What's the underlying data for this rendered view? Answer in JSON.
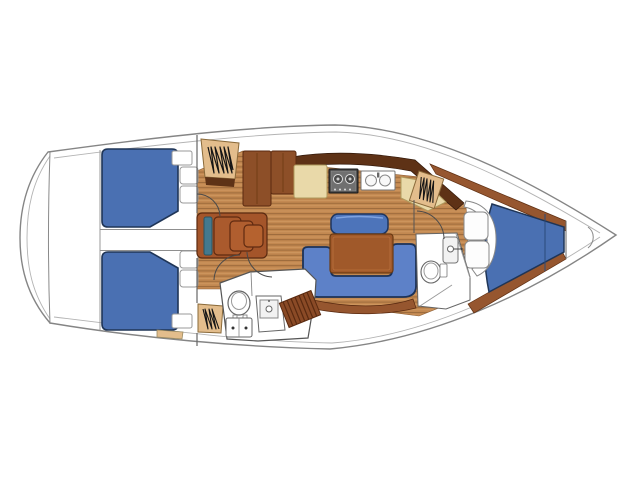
{
  "diagram": {
    "type": "sailing-yacht-interior-floor-plan",
    "orientation": "bow-right-stern-left",
    "areas": [
      {
        "id": "stern-platform",
        "fixtures": [
          "transom-curve"
        ]
      },
      {
        "id": "aft-cabin-port",
        "fixtures": [
          "double-berth",
          "pillow",
          "pillow",
          "corner-seat",
          "hanging-locker",
          "door"
        ]
      },
      {
        "id": "aft-cabin-starboard",
        "fixtures": [
          "double-berth",
          "pillow",
          "pillow",
          "corner-seat",
          "hanging-locker",
          "door"
        ]
      },
      {
        "id": "companionway",
        "fixtures": [
          "steps",
          "grab-rail"
        ]
      },
      {
        "id": "galley",
        "fixtures": [
          "cabinet-unit",
          "counter",
          "two-burner-stove",
          "double-sink",
          "counter"
        ]
      },
      {
        "id": "salon",
        "fixtures": [
          "wood-sole",
          "u-settee",
          "dining-table",
          "bench-seat"
        ]
      },
      {
        "id": "aft-head",
        "fixtures": [
          "toilet",
          "sink-vanity",
          "drawer-unit",
          "teak-grating",
          "door"
        ]
      },
      {
        "id": "forward-head",
        "fixtures": [
          "toilet",
          "sink-cabinet",
          "partition-wall"
        ]
      },
      {
        "id": "forward-cabin",
        "fixtures": [
          "v-berth",
          "curved-seat",
          "hanging-locker",
          "door"
        ]
      },
      {
        "id": "bow",
        "fixtures": [
          "anchor-locker"
        ]
      }
    ],
    "symbols": {
      "hanging-locker": "zigzag-scribble",
      "door": "quarter-circle-swing-arc",
      "toilet": "oval-bowl",
      "sink": "circle-basin",
      "stove": "rect-with-burner-circles"
    }
  },
  "palette": {
    "hull_white": "#ffffff",
    "hull_stroke": "#858585",
    "wood_base": "#c28850",
    "wood_dark": "#9d6b3c",
    "wood_light": "#d19a62",
    "berth_blue": "#4a70b2",
    "berth_border": "#1f3557",
    "settee_blue": "#5d81c8",
    "bench_blue": "#4d74ba",
    "table_brown": "#a0592a",
    "steps_brown": "#a4552a",
    "steps_teal": "#44798e",
    "cabinet_brown": "#8d4f28",
    "dark_walnut": "#5e3216",
    "trim_brown": "#96562f",
    "counter_cream": "#e9d9a9",
    "locker_tan": "#e3bd8c",
    "stove_gray": "#3f3f3f"
  }
}
